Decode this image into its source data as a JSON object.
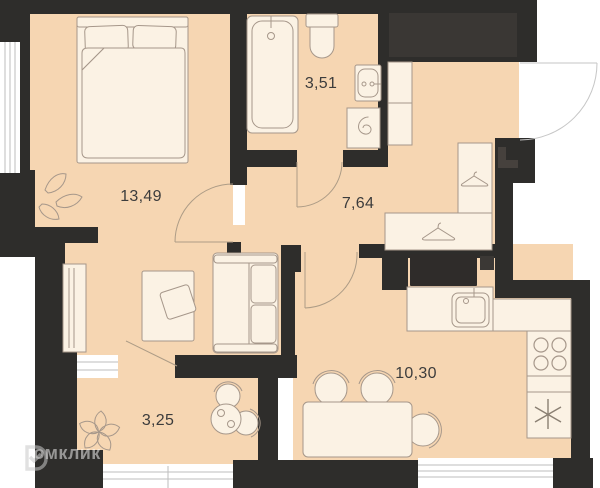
{
  "plan": {
    "title": "apartment-floor-plan",
    "rooms": [
      {
        "id": "bedroom-living",
        "area": "13,49"
      },
      {
        "id": "bathroom",
        "area": "3,51"
      },
      {
        "id": "hallway",
        "area": "7,64"
      },
      {
        "id": "loggia",
        "area": "3,25"
      },
      {
        "id": "kitchen",
        "area": "10,30"
      }
    ],
    "watermark": {
      "brand": "Домклик",
      "logo_icon": "domclick-logo-icon"
    },
    "colors": {
      "floor": "#f6d6b2",
      "wall": "#2e2d2b",
      "shaft": "#3a3734",
      "furniture": "#fbf2e4",
      "appliance_dark": "#2f2c2a",
      "outline": "#a6978a",
      "window": "#ffffff",
      "window_frame": "#bdbdbd",
      "door_arc": "#ad9c86",
      "label_text": "#3c3c3c"
    },
    "icons": [
      "bed-icon",
      "pillow-icon",
      "plant-icon",
      "flower-icon",
      "wardrobe-icon",
      "desk-icon",
      "chair-icon",
      "sofa-icon",
      "bathtub-icon",
      "toilet-icon",
      "washbasin-icon",
      "washing-machine-icon",
      "hanger-icon",
      "cabinet-icon",
      "fridge-icon",
      "kitchen-sink-icon",
      "stove-icon",
      "asterisk-icon",
      "dining-table-icon",
      "bistro-table-icon",
      "door-arc-icon",
      "entrance-door-icon",
      "window-icon",
      "ventilation-shaft-icon",
      "domclick-logo-icon"
    ]
  }
}
